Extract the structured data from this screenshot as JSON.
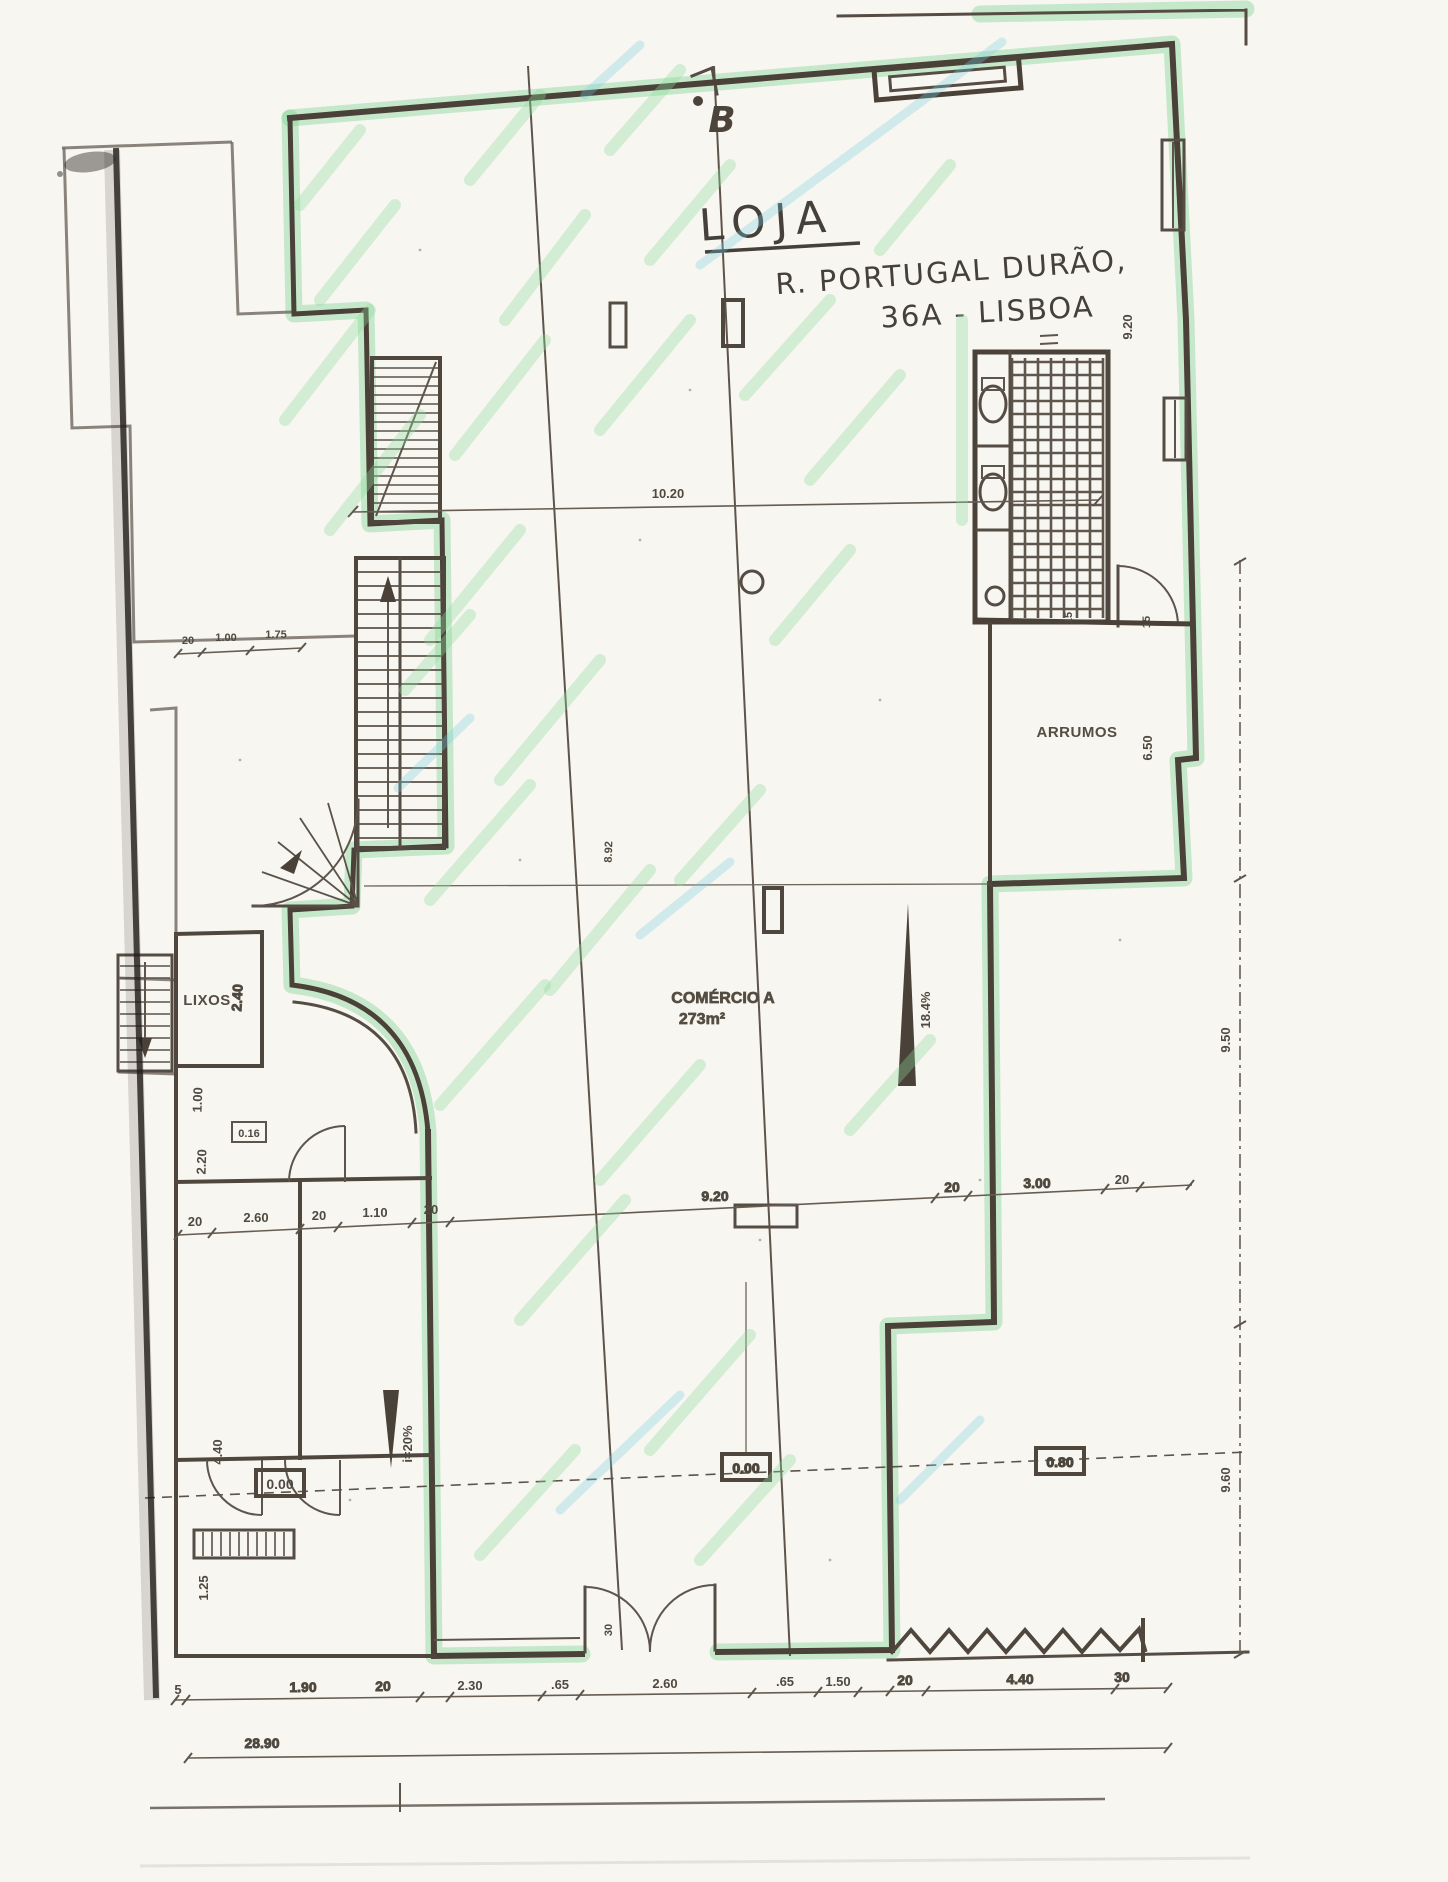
{
  "handwriting": {
    "title": "LOJA",
    "address_line1": "R. PORTUGAL DURÃO,",
    "address_line2": "36A - LISBOA",
    "section_letter": "B"
  },
  "rooms": {
    "commerce_name": "COMÉRCIO A",
    "commerce_area": "273m²",
    "storage": "ARRUMOS",
    "trash": "LIXOS"
  },
  "levels": {
    "entry": "0.00",
    "interior": "0.00",
    "raised": "0.80",
    "wall_marker": "0.16"
  },
  "slopes": {
    "interior_ramp": "18.4%",
    "entry_ramp": "i=20%"
  },
  "dims": {
    "top_span": "10.20",
    "upper_left_chain": [
      "20",
      "1.00",
      "1.75"
    ],
    "middle_chain": [
      "20",
      "2.60",
      "20",
      "1.10",
      "20",
      "9.20",
      "20",
      "3.00",
      "20"
    ],
    "bottom_chain": [
      "5",
      "1.90",
      "20",
      "2.30",
      ".65",
      "2.60",
      ".65",
      "1.50",
      "20",
      "4.40",
      "30"
    ],
    "bottom_total": "28.90",
    "left_side": [
      "2.40",
      "1.00",
      "2.20",
      "4.40",
      "1.25"
    ],
    "right_side": [
      "9.20",
      "6.50",
      "9.50",
      "9.60"
    ],
    "wc_door": [
      "15",
      "15"
    ],
    "entry_door": "30",
    "center_line": "8.92"
  }
}
